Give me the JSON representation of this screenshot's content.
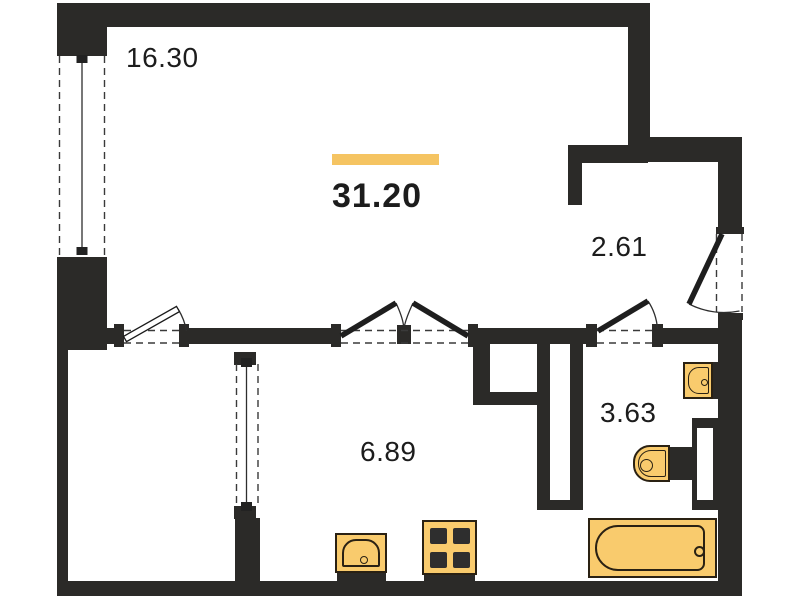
{
  "title": "Apartment floor plan",
  "total": {
    "area": "31.20"
  },
  "rooms": [
    {
      "key": "living-room",
      "area": "16.30"
    },
    {
      "key": "hallway",
      "area": "2.61"
    },
    {
      "key": "bathroom",
      "area": "3.63"
    },
    {
      "key": "kitchen",
      "area": "6.89"
    }
  ],
  "icons": [
    "window",
    "door",
    "double-door",
    "entrance-door",
    "bathtub",
    "toilet",
    "washbasin",
    "kitchen-sink",
    "stove",
    "duct-shaft"
  ],
  "colors": {
    "wall": "#2b2a28",
    "background": "#ffffff",
    "text": "#1c1c1c",
    "accent-bar": "#F5C462",
    "fixture-fill": "#F9CB6D",
    "fixture-stroke": "#2a2113"
  }
}
